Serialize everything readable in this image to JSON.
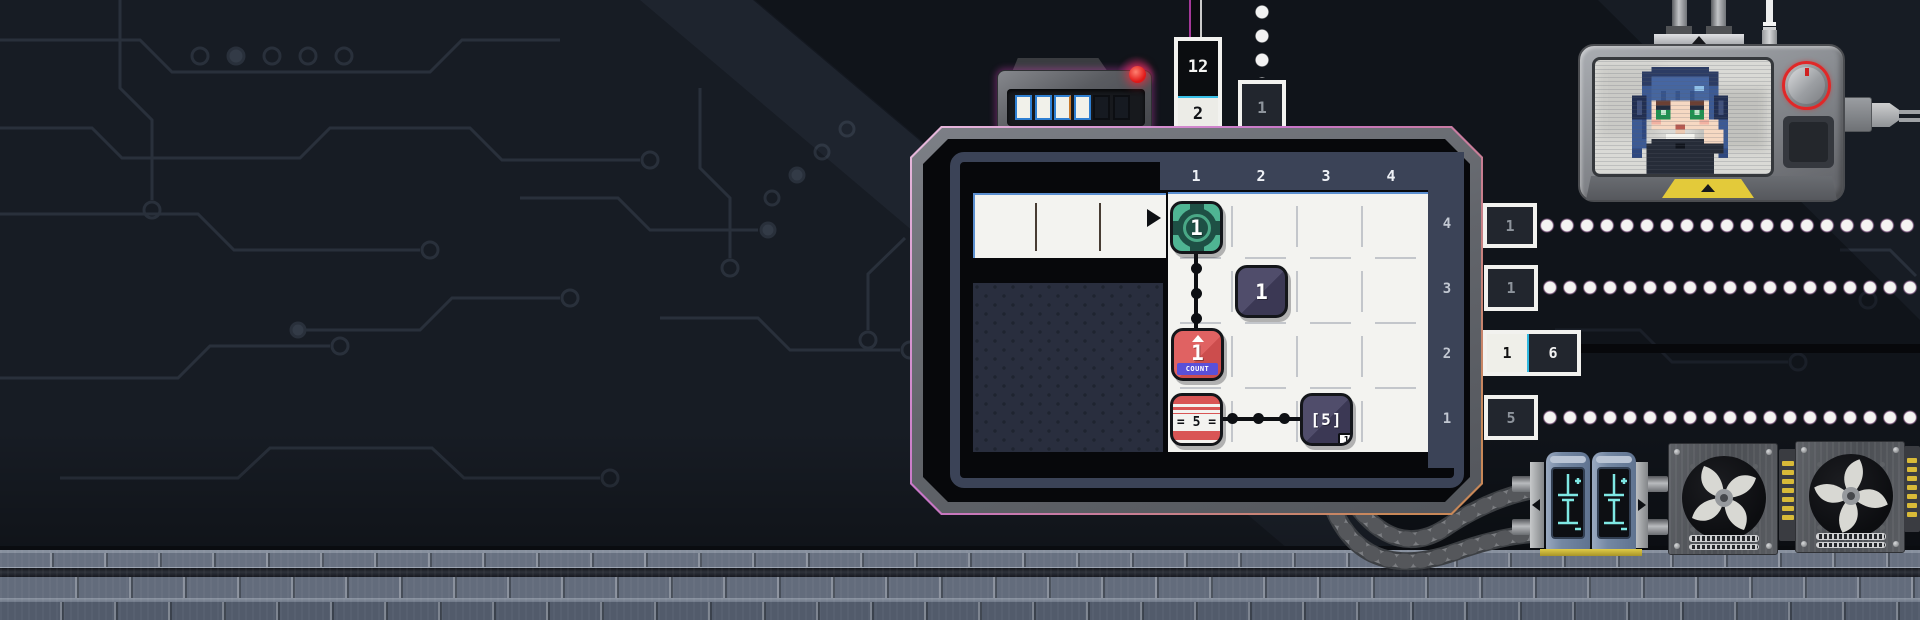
{
  "board": {
    "column_labels": [
      "1",
      "2",
      "3",
      "4"
    ],
    "row_labels": [
      "4",
      "3",
      "2",
      "1"
    ],
    "nodes": {
      "target": {
        "value": "1"
      },
      "tile": {
        "value": "1"
      },
      "counter": {
        "value": "1",
        "label": "COUNT"
      },
      "equals": {
        "value": "= 5 ="
      },
      "array": {
        "value": "[5]",
        "badge": "1"
      }
    }
  },
  "column_inputs": {
    "col1_top": "12",
    "col1_bottom": "2",
    "col2": "1"
  },
  "row_outputs": {
    "row4": "1",
    "row3": "1",
    "row2_left": "1",
    "row2_right": "6",
    "row1": "5"
  },
  "slot_tray": {
    "slot_states": [
      "filled",
      "filled",
      "filled",
      "filled",
      "empty",
      "empty"
    ]
  },
  "icons": {
    "play_arrow": "play-arrow",
    "led": "red-led",
    "target": "target-crosshair",
    "up_arrow": "up-arrow",
    "warning": "warning-triangle",
    "fan": "fan-blades",
    "capacitor": "capacitor-glyph",
    "mascot": "pixel-girl-thumbs-up"
  },
  "colors": {
    "accent_magenta": "#d85ac8",
    "node_green": "#4fb593",
    "node_red": "#d95555",
    "node_navy": "#474460",
    "banner_purple": "#5a50d8",
    "led_red": "#e01818",
    "capacitor_cyan": "#7ee7e3",
    "knob_ring_red": "#e02828",
    "sign_yellow": "#e3ca3a"
  }
}
